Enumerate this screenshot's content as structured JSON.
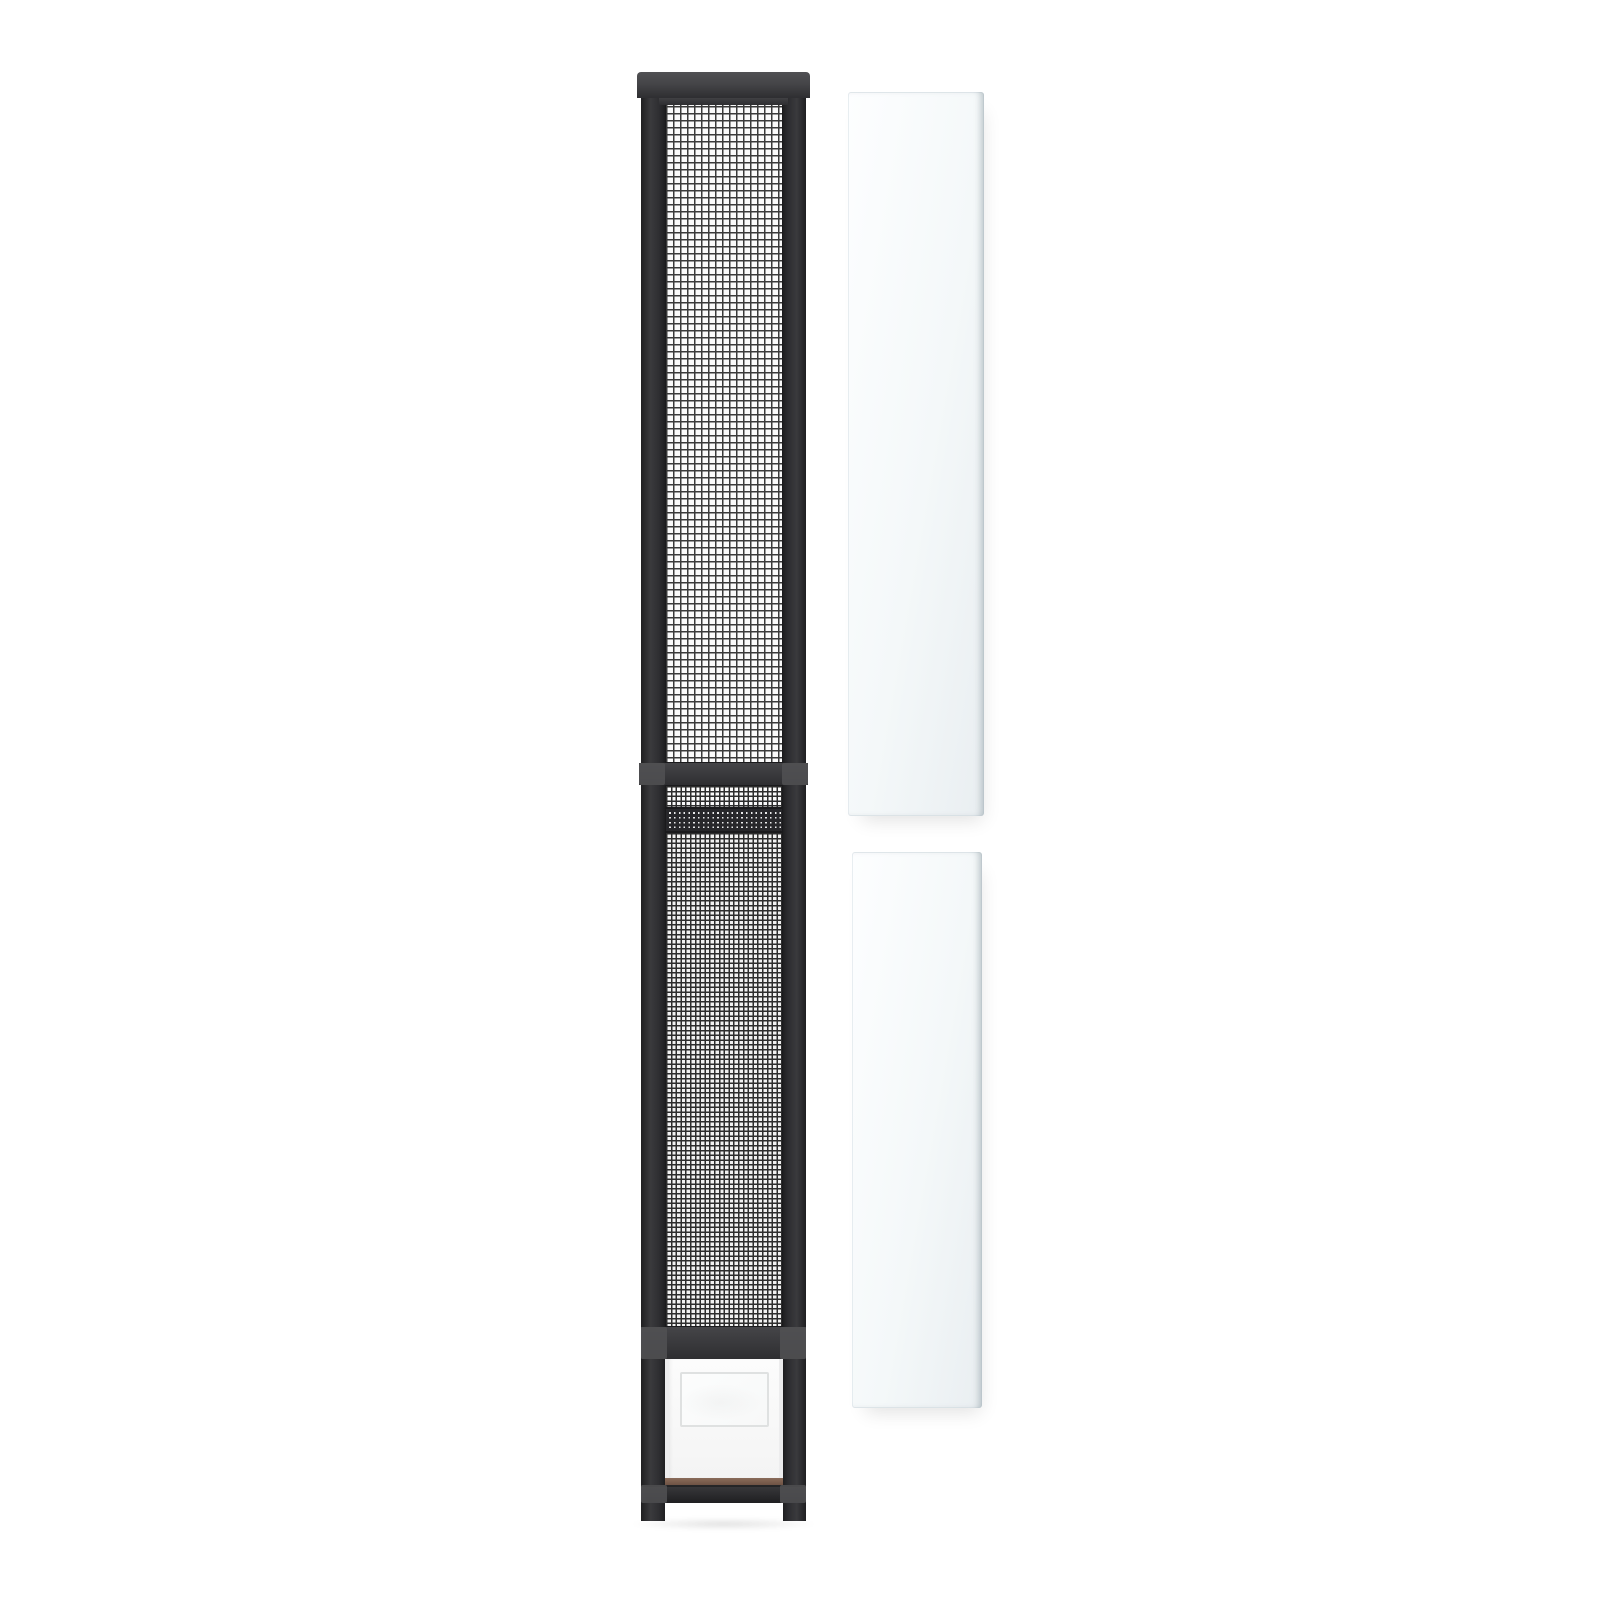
{
  "image_kind": "product-photo",
  "subject": "sliding-door-screen-insert-with-pet-flap-and-two-glass-panels",
  "visible_text": "",
  "parts": {
    "assembly": "screen-door-assembly",
    "top_cap": "top-frame-cap",
    "left_rail": "left-frame-rail",
    "right_rail": "right-frame-rail",
    "upper_mesh": "upper-screen-mesh",
    "junction_bar": "telescoping-junction-crossbar",
    "single_mesh_strip": "single-layer-mesh-strip",
    "overlap_mesh": "overlapping-mesh-band",
    "lower_mesh": "lower-screen-mesh",
    "pet_top_bar": "pet-door-top-crossbar",
    "flap_panel": "pet-door-white-panel",
    "flap": "pet-door-flap",
    "kick_strip": "threshold-kick-strip",
    "bottom_bar": "bottom-frame-bar",
    "glass_upper": "glass-side-panel-upper",
    "glass_lower": "glass-side-panel-lower"
  },
  "colors": {
    "bg": "#ffffff",
    "frame": "#2e2e31",
    "frame-deep": "#1f1f21",
    "frame-mid": "#3a3a3d",
    "frame-cap": "#454548",
    "frame-hi": "#515154",
    "mesh-bg": "#fafafa",
    "mesh-line": "#3a3a3a",
    "mesh2-bg": "#f1f1f1",
    "mesh2-line": "#2d2d2d",
    "overlap-bg": "#eaeaea",
    "overlap-line": "#27272a",
    "flap-bg": "#fcfcfc",
    "flap-edge": "#ededee",
    "flap-line": "#dfe1e1",
    "kick": "#6e5244",
    "glass-a": "#fdfeff",
    "glass-b": "#f4f8f9",
    "glass-c": "#e9eef1",
    "shadow": "rgba(0,0,0,0.12)"
  }
}
